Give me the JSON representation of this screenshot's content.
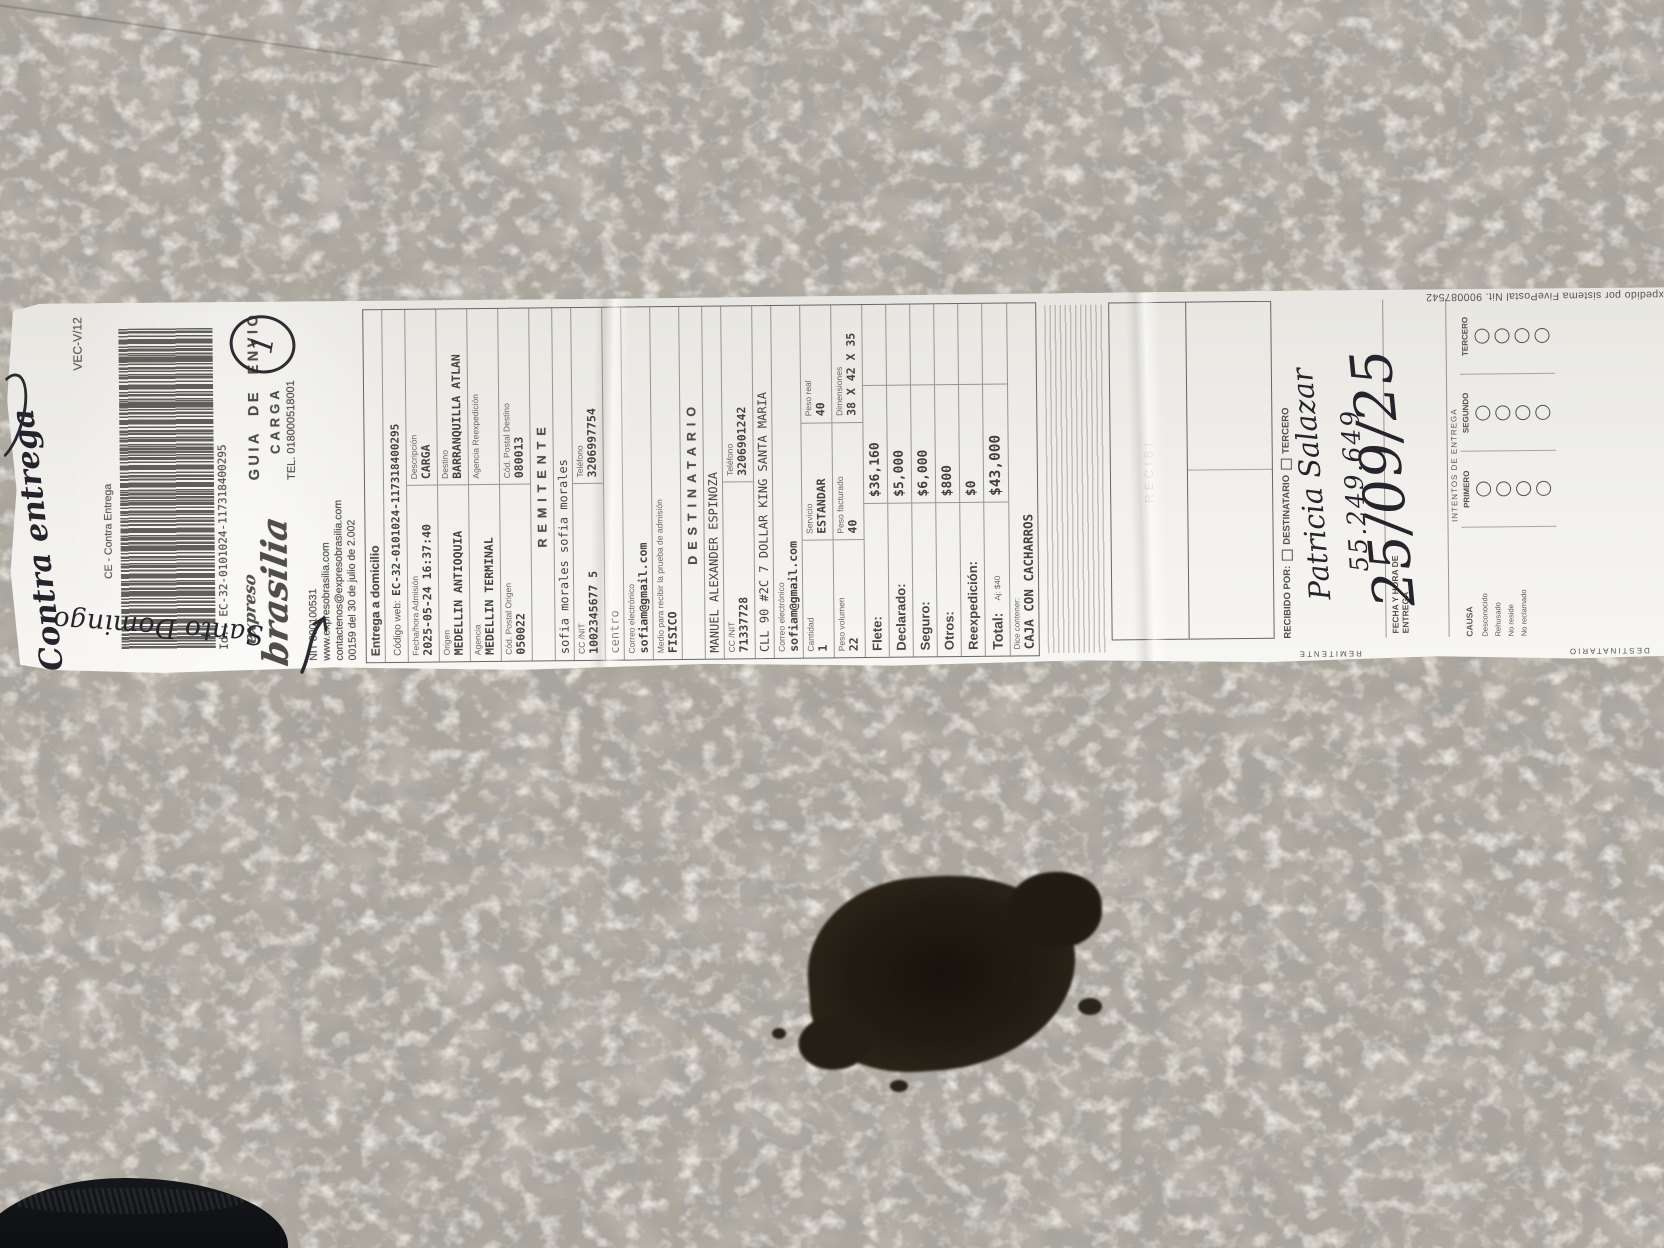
{
  "receipt": {
    "handwritten": {
      "contra_entrega": "Contra entrega",
      "santo_domingo": "Santo Domingo",
      "circled_mark": "1",
      "receiver_name": "Patricia Salazar",
      "receiver_id": "55.249.649",
      "delivery_date": "25/09/25"
    },
    "header": {
      "version": "VEC-V/12",
      "service_type": "CE - Contra Entrega",
      "barcode_id": "Id.: EC-32-0101024-117318400295",
      "brand_top": "expreso",
      "brand": "brasilia",
      "doc_title": "GUIA DE ENVIO",
      "doc_subtitle": "CARGA",
      "phone": "TEL. 018000518001",
      "nit": "NIT 890100531",
      "website": "www.expresobrasilia.com",
      "contact_email": "contactenos@expresobrasilia.com",
      "resolution": "00159 del 30 de julio de 2.002"
    },
    "shipment": {
      "title": "Entrega a domicilio",
      "codigo_web_label": "Código web:",
      "codigo_web": "EC-32-0101024-117318400295",
      "fecha_admision_label": "Fecha/hora Admisión",
      "fecha_admision": "2025-05-24 16:37:40",
      "descripcion_label": "Descripción",
      "descripcion": "CARGA",
      "origen_label": "Origen",
      "origen": "MEDELLIN ANTIOQUIA",
      "destino_label": "Destino",
      "destino": "BARRANQUILLA ATLAN",
      "agencia_label": "Agencia",
      "agencia": "MEDELLIN TERMINAL",
      "agencia_reexpedicion_label": "Agencia Reexpedición",
      "agencia_reexpedicion": "",
      "cp_origen_label": "Cód. Postal Origen",
      "cp_origen": "050022",
      "cp_destino_label": "Cód. Postal Destino",
      "cp_destino": "080013"
    },
    "remitente": {
      "section_title": "REMITENTE",
      "nombre": "sofia morales sofia morales",
      "cc_label": "CC /NIT",
      "cc": "1002345677 5",
      "tel_label": "Teléfono",
      "tel": "3206997754",
      "direccion": "centro",
      "correo_label": "Correo electrónico",
      "correo": "sofiam@gmail.com",
      "medio_label": "Medio para recibir la prueba de admisión",
      "medio": "FISICO"
    },
    "destinatario": {
      "section_title": "DESTINATARIO",
      "nombre": "MANUEL ALEXANDER ESPINOZA",
      "cc_label": "CC /NIT",
      "cc": "71337728",
      "tel_label": "Teléfono",
      "tel": "3206901242",
      "direccion": "CLL 90 #2C 7 DOLLAR KING SANTA MARIA",
      "correo_label": "Correo electrónico",
      "correo": "sofiam@gmail.com"
    },
    "paquete": {
      "cantidad_label": "Cantidad",
      "cantidad": "1",
      "servicio_label": "Servicio",
      "servicio": "ESTANDAR",
      "peso_real_label": "Peso real",
      "peso_real": "40",
      "peso_volumen_label": "Peso volumen",
      "peso_volumen": "22",
      "peso_facturado_label": "Peso facturado",
      "peso_facturado": "40",
      "dimensiones_label": "Dimensiones",
      "dimensiones": "38 X 42 X 35"
    },
    "cobros": {
      "flete_label": "Flete:",
      "flete": "$36,160",
      "declarado_label": "Declarado:",
      "declarado": "$5,000",
      "seguro_label": "Seguro:",
      "seguro": "$6,000",
      "otros_label": "Otros:",
      "otros": "$800",
      "reexpedicion_label": "Reexpedición:",
      "reexpedicion": "$0",
      "total_label": "Total:",
      "total_ajuste": "Aj: $40",
      "total": "$43,000"
    },
    "contenido": {
      "label": "Dice contener:",
      "valor": "CAJA CON CACHARROS"
    },
    "delivery": {
      "recibi": "RECIBI",
      "tab_remitente": "REMITENTE",
      "tab_destinatario": "DESTINATARIO",
      "recibido_por_label": "RECIBIDO POR:",
      "check_destinatario": "DESTINATARIO",
      "check_tercero": "TERCERO",
      "fecha_entrega_label": "FECHA Y HORA DE ENTREGA",
      "intentos_label": "INTENTOS DE ENTREGA",
      "intento_1": "PRIMERO",
      "intento_2": "SEGUNDO",
      "intento_3": "TERCERO",
      "causa_label": "CAUSA",
      "causas": [
        "Desconocido",
        "Rehusado",
        "No reside",
        "No reclamado"
      ],
      "sistema": "expedido por sistema FivePostal Nit. 900087542"
    },
    "palette": {
      "paper": "#f1f0ec",
      "ink": "#4b4945",
      "pen": "#26252d",
      "concrete": "#a8a49a",
      "stain": "#1f1a12"
    }
  }
}
